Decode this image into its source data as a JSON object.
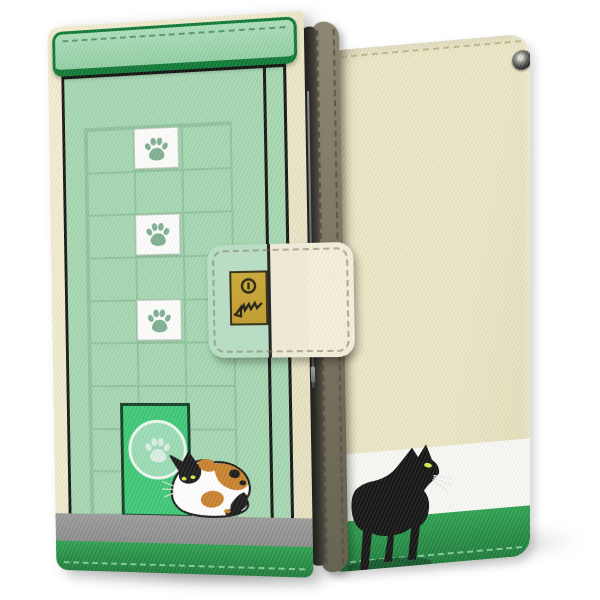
{
  "scene": {
    "name": "smartphone-flip-case-product-photo",
    "description": "Front and back views of a wallet-style smartphone flip case with a cat apartment illustration: green building with paw-print windows, a cat door, a calico cat on the front, and a black cat on the cream back.",
    "background": "#ffffff"
  },
  "palette": {
    "pageBg": "#ffffff",
    "caseCream": "#eee9cb",
    "backCream": "#ece7c6",
    "wallGreen": "#a6d7b2",
    "gridGreen": "#8dc29c",
    "awningFill": "#abdfba",
    "awningEdge": "#0f7a36",
    "frameBlack": "#161616",
    "claspMint": "#b9e2c6",
    "claspCream": "#f4f0da",
    "lockGold": "#c19a25",
    "doorGreen": "#3fc878",
    "doorEdge": "#123f24",
    "doorCircle": "#9bdcb5",
    "pawOnWindow": "#7fb092",
    "pawOnDoor": "#ddefe3",
    "sidewalkGray": "#9b9b9b",
    "bandGreenTop": "#2fa251",
    "bandGreenBottom": "#1f7c3c",
    "stitchGreen": "#8fd8a5",
    "stitchCream": "#b8b18a",
    "whiteBand": "#f8f8f5",
    "spineOlive": "#817b66",
    "phoneDark": "#3c3a33",
    "catBlack": "#151515",
    "catShadowGreen": "#15522b",
    "calicoOrange": "#c9822e",
    "calicoOutline": "#191919",
    "eyeYellow": "#dce94f",
    "metalDark": "#4a4a46",
    "metalLight": "#d8d8d2"
  },
  "front_cover": {
    "name": "front-cover-view",
    "window_grid": {
      "columns": 3,
      "rows": 9
    },
    "paw_window_rows": [
      0,
      2,
      4
    ],
    "paw_window_count": 3,
    "elements": [
      "green-awning",
      "window-grid",
      "paw-windows",
      "lock-clasp",
      "keyhole",
      "scratch-scribble",
      "cat-door",
      "door-paw-medallion",
      "calico-cat",
      "sidewalk-band",
      "green-hem",
      "stitching"
    ]
  },
  "back_cover": {
    "name": "back-cover-view",
    "elements": [
      "top-stitch-line",
      "strap-eyelet",
      "black-cat-silhouette",
      "cat-tail-tip",
      "white-band",
      "green-hem",
      "stitching"
    ]
  }
}
